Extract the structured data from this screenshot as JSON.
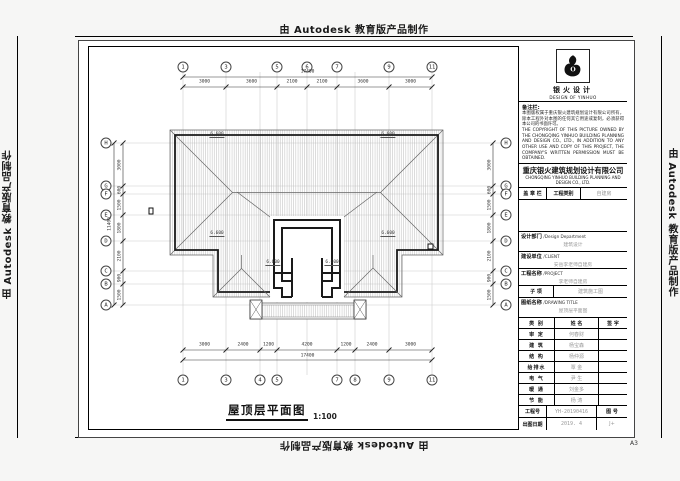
{
  "watermark": {
    "text": "由 Autodesk 教育版产品制作"
  },
  "sheet": {
    "size_label": "A3"
  },
  "title_block": {
    "logo": {
      "name_cn": "银火设计",
      "name_en": "DESIGN OF YINHUO"
    },
    "remarks": {
      "label": "备注栏:",
      "text_cn": "本图版权属于重庆银火建筑规划设计有限公司所有，除本工程外对本图的任何其它用途或复制，必须获得本公司的书面许可。",
      "text_en": "THE COPYRIGHT OF THIS PICTURE OWNED BY THE CHONGQING YINHUO BUILDING PLANNING AND DESIGN CO., LTD., IN ADDITION TO ANY OTHER USE AND COPY OF THIS PROJECT, THE COMPANY'S WRITTEN PERMISSION MUST BE OBTAINED."
    },
    "company": {
      "name_cn": "重庆银火建筑规划设计有限公司",
      "name_en": "CHONGQING YINHUO BUILDING PLANNING AND DESIGN CO., LTD."
    },
    "stamp_row": {
      "stamp_label": "盖 章 栏",
      "category_label": "工程类别",
      "category_value": "自建房"
    },
    "dept": {
      "label": "设计部门",
      "label_en": "/Design Department",
      "value": "建筑设计"
    },
    "client": {
      "label": "建设单位",
      "label_en": "/CLIENT",
      "value": "安岳李老师自建房"
    },
    "project": {
      "label": "工程名称",
      "label_en": "/PROJECT",
      "value": "李老师自建房"
    },
    "subitem": {
      "label": "子  项",
      "value": "建筑施工图"
    },
    "drawing_title": {
      "label": "图纸名称",
      "label_en": "/DRAWING TITLE",
      "value": "屋顶层平面图"
    },
    "sign_table": {
      "headers": [
        "类 别",
        "姓 名",
        "签 字"
      ],
      "rows": [
        {
          "role": "审 定",
          "name": "何春财",
          "sign": ""
        },
        {
          "role": "建 筑",
          "name": "杨宝森",
          "sign": ""
        },
        {
          "role": "结 构",
          "name": "杨仲源",
          "sign": ""
        },
        {
          "role": "给排水",
          "name": "覃 金",
          "sign": ""
        },
        {
          "role": "电 气",
          "name": "尹 生",
          "sign": ""
        },
        {
          "role": "暖 通",
          "name": "刘金多",
          "sign": ""
        },
        {
          "role": "节 能",
          "name": "杨 涛",
          "sign": ""
        }
      ]
    },
    "project_no": {
      "label": "工程号",
      "value": "YH-20190416"
    },
    "drawing_no": {
      "label": "图 号",
      "value": "J+"
    },
    "date": {
      "label": "出图日期",
      "value": "2019. 4"
    }
  },
  "drawing": {
    "plan_title": "屋顶层平面图",
    "plan_scale": "1:100",
    "grid_top": [
      "1",
      "3",
      "5",
      "6",
      "7",
      "9",
      "11"
    ],
    "grid_bottom": [
      "1",
      "3",
      "4",
      "5",
      "7",
      "8",
      "9",
      "11"
    ],
    "grid_left": [
      "H",
      "G",
      "F",
      "E",
      "D",
      "C",
      "B",
      "A"
    ],
    "grid_right": [
      "H",
      "G",
      "F",
      "E",
      "D",
      "C",
      "B",
      "A"
    ],
    "dim_top": [
      "3000",
      "3600",
      "2100",
      "2100",
      "3600",
      "3000"
    ],
    "dim_top_total": "17400",
    "dim_bottom": [
      "3000",
      "2400",
      "1200",
      "4200",
      "1200",
      "2400",
      "3000"
    ],
    "dim_bottom_total": "17400",
    "dim_left": [
      "3000",
      "600",
      "1500",
      "1800",
      "2100",
      "900",
      "1500"
    ],
    "dim_left_total": "11400",
    "dim_right": [
      "3000",
      "600",
      "1500",
      "1800",
      "2100",
      "900",
      "1500"
    ],
    "elevations": [
      "6.600",
      "6.600",
      "6.600",
      "6.600",
      "6.600",
      "6.600"
    ]
  }
}
